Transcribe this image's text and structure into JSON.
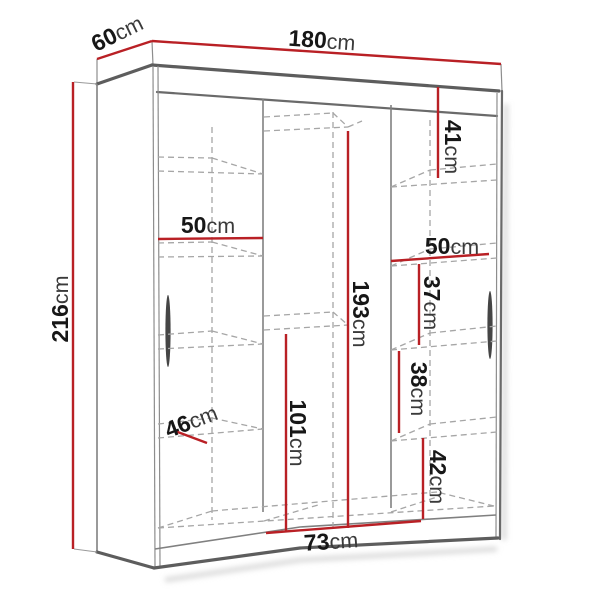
{
  "title": "Wardrobe dimension diagram",
  "unit": "cm",
  "colors": {
    "dimension_red": "#b92025",
    "outline_gray": "#5d5d5d",
    "dashed_gray": "#a6a6a6",
    "text": "#171717",
    "background": "#ffffff"
  },
  "dimensions": {
    "width": {
      "value": "180",
      "unit": "cm"
    },
    "depth": {
      "value": "60",
      "unit": "cm"
    },
    "height": {
      "value": "216",
      "unit": "cm"
    },
    "top_right_section_height": {
      "value": "41",
      "unit": "cm"
    },
    "left_shelf_width": {
      "value": "50",
      "unit": "cm"
    },
    "right_shelf_width": {
      "value": "50",
      "unit": "cm"
    },
    "right_upper_section_height": {
      "value": "37",
      "unit": "cm"
    },
    "hanging_section_height": {
      "value": "193",
      "unit": "cm"
    },
    "right_middle_section_height": {
      "value": "38",
      "unit": "cm"
    },
    "shelf_depth": {
      "value": "46",
      "unit": "cm"
    },
    "lower_section_height": {
      "value": "101",
      "unit": "cm"
    },
    "right_lower_section_height": {
      "value": "42",
      "unit": "cm"
    },
    "bottom_section_width": {
      "value": "73",
      "unit": "cm"
    }
  }
}
